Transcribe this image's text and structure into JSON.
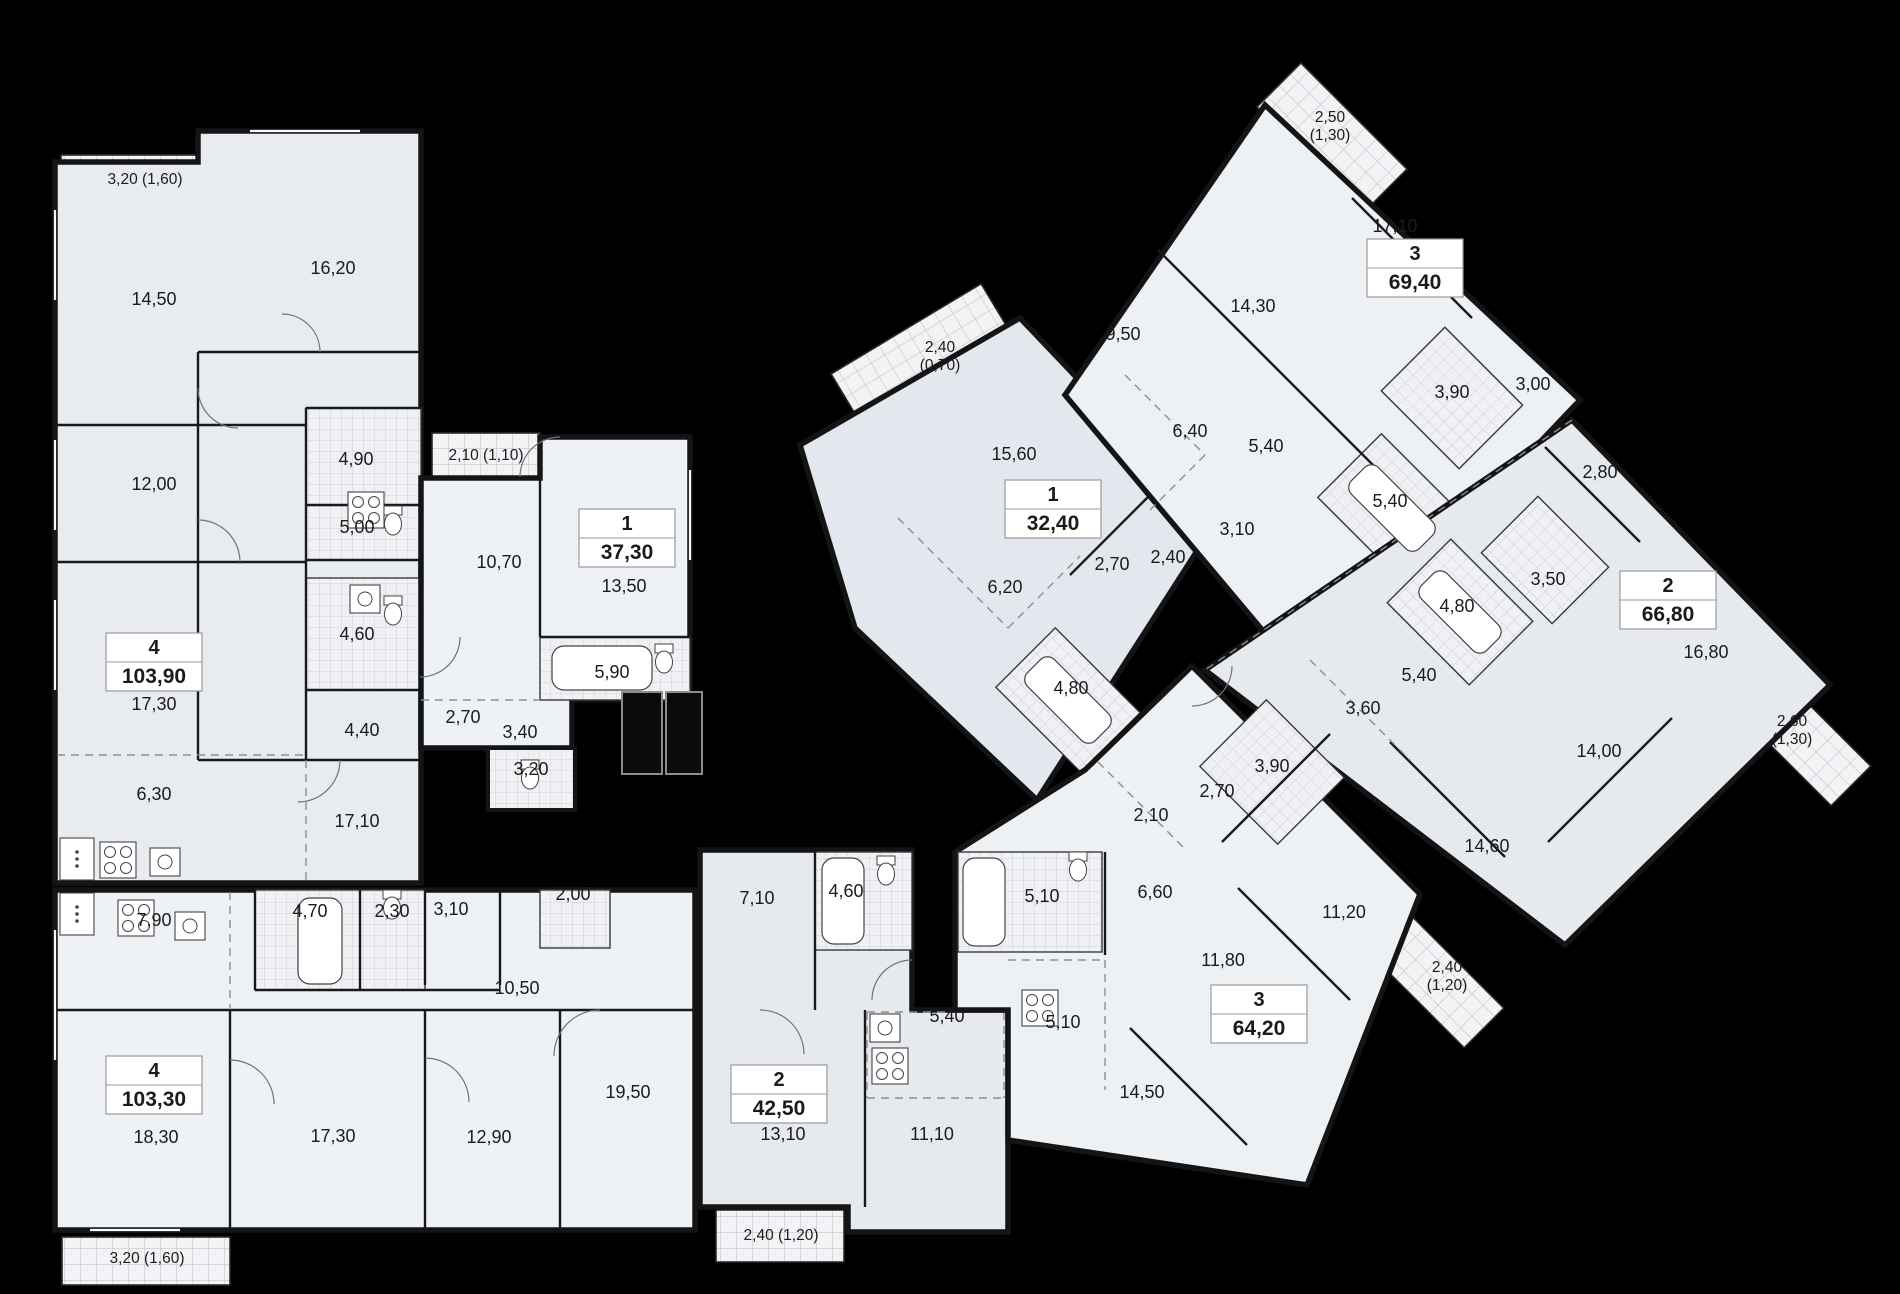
{
  "plan": {
    "background": "#000000",
    "wall_color": "#141414",
    "floor_color": "#e9edf2",
    "apartments": [
      {
        "id": "apt-4-top",
        "number": "4",
        "area": "103,90",
        "badge": {
          "x": 154,
          "y": 662
        },
        "rooms": [
          {
            "label": "14,50",
            "x": 154,
            "y": 305
          },
          {
            "label": "16,20",
            "x": 333,
            "y": 274
          },
          {
            "label": "12,00",
            "x": 154,
            "y": 490
          },
          {
            "label": "4,90",
            "x": 356,
            "y": 465
          },
          {
            "label": "5,00",
            "x": 357,
            "y": 533
          },
          {
            "label": "4,60",
            "x": 357,
            "y": 640
          },
          {
            "label": "17,30",
            "x": 154,
            "y": 710
          },
          {
            "label": "4,40",
            "x": 362,
            "y": 736
          },
          {
            "label": "6,30",
            "x": 154,
            "y": 800
          },
          {
            "label": "17,10",
            "x": 357,
            "y": 827
          }
        ],
        "balconies": [
          {
            "label": "3,20 (1,60)",
            "x": 145,
            "y": 184,
            "stacked": false
          }
        ]
      },
      {
        "id": "apt-1-37",
        "number": "1",
        "area": "37,30",
        "badge": {
          "x": 627,
          "y": 538
        },
        "rooms": [
          {
            "label": "10,70",
            "x": 499,
            "y": 568
          },
          {
            "label": "13,50",
            "x": 624,
            "y": 592
          },
          {
            "label": "5,90",
            "x": 612,
            "y": 678
          },
          {
            "label": "2,70",
            "x": 463,
            "y": 723
          },
          {
            "label": "3,40",
            "x": 520,
            "y": 738
          },
          {
            "label": "3,20",
            "x": 531,
            "y": 775
          }
        ],
        "balconies": [
          {
            "label": "2,10 (1,10)",
            "x": 486,
            "y": 460,
            "stacked": false
          }
        ]
      },
      {
        "id": "apt-4-bottom",
        "number": "4",
        "area": "103,30",
        "badge": {
          "x": 154,
          "y": 1085
        },
        "rooms": [
          {
            "label": "7,90",
            "x": 154,
            "y": 926
          },
          {
            "label": "4,70",
            "x": 310,
            "y": 917
          },
          {
            "label": "2,30",
            "x": 392,
            "y": 917
          },
          {
            "label": "3,10",
            "x": 451,
            "y": 915
          },
          {
            "label": "2,00",
            "x": 573,
            "y": 900
          },
          {
            "label": "10,50",
            "x": 517,
            "y": 994
          },
          {
            "label": "18,30",
            "x": 156,
            "y": 1143
          },
          {
            "label": "17,30",
            "x": 333,
            "y": 1142
          },
          {
            "label": "12,90",
            "x": 489,
            "y": 1143
          },
          {
            "label": "19,50",
            "x": 628,
            "y": 1098
          }
        ],
        "balconies": [
          {
            "label": "3,20 (1,60)",
            "x": 147,
            "y": 1263,
            "stacked": false
          }
        ]
      },
      {
        "id": "apt-2-42",
        "number": "2",
        "area": "42,50",
        "badge": {
          "x": 779,
          "y": 1094
        },
        "rooms": [
          {
            "label": "7,10",
            "x": 757,
            "y": 904
          },
          {
            "label": "4,60",
            "x": 846,
            "y": 897
          },
          {
            "label": "5,40",
            "x": 947,
            "y": 1022
          },
          {
            "label": "13,10",
            "x": 783,
            "y": 1140
          },
          {
            "label": "11,10",
            "x": 932,
            "y": 1140
          }
        ],
        "balconies": [
          {
            "label": "2,40 (1,20)",
            "x": 781,
            "y": 1240,
            "stacked": false
          }
        ]
      },
      {
        "id": "apt-1-32",
        "number": "1",
        "area": "32,40",
        "badge": {
          "x": 1053,
          "y": 509
        },
        "rooms": [
          {
            "label": "15,60",
            "x": 1014,
            "y": 460
          },
          {
            "label": "6,20",
            "x": 1005,
            "y": 593
          },
          {
            "label": "2,70",
            "x": 1112,
            "y": 570
          },
          {
            "label": "2,40",
            "x": 1168,
            "y": 563
          },
          {
            "label": "4,80",
            "x": 1071,
            "y": 694
          }
        ],
        "balconies": [
          {
            "label": "2,40 (0,70)",
            "x": 940,
            "y": 352,
            "stacked": true
          }
        ]
      },
      {
        "id": "apt-3-69",
        "number": "3",
        "area": "69,40",
        "badge": {
          "x": 1415,
          "y": 268
        },
        "rooms": [
          {
            "label": "17,10",
            "x": 1395,
            "y": 232
          },
          {
            "label": "14,30",
            "x": 1253,
            "y": 312
          },
          {
            "label": "9,50",
            "x": 1123,
            "y": 340
          },
          {
            "label": "6,40",
            "x": 1190,
            "y": 437
          },
          {
            "label": "5,40",
            "x": 1266,
            "y": 452
          },
          {
            "label": "3,10",
            "x": 1237,
            "y": 535
          },
          {
            "label": "3,90",
            "x": 1452,
            "y": 398
          },
          {
            "label": "5,40",
            "x": 1390,
            "y": 507
          },
          {
            "label": "3,00",
            "x": 1533,
            "y": 390
          }
        ],
        "balconies": [
          {
            "label": "2,50 (1,30)",
            "x": 1330,
            "y": 122,
            "stacked": true
          }
        ]
      },
      {
        "id": "apt-2-66",
        "number": "2",
        "area": "66,80",
        "badge": {
          "x": 1668,
          "y": 600
        },
        "rooms": [
          {
            "label": "2,80",
            "x": 1600,
            "y": 478
          },
          {
            "label": "3,50",
            "x": 1548,
            "y": 585
          },
          {
            "label": "4,80",
            "x": 1457,
            "y": 612
          },
          {
            "label": "5,40",
            "x": 1419,
            "y": 681
          },
          {
            "label": "3,60",
            "x": 1363,
            "y": 714
          },
          {
            "label": "16,80",
            "x": 1706,
            "y": 658
          },
          {
            "label": "14,00",
            "x": 1599,
            "y": 757
          },
          {
            "label": "14,60",
            "x": 1487,
            "y": 852
          }
        ],
        "balconies": [
          {
            "label": "2,60 (1,30)",
            "x": 1792,
            "y": 726,
            "stacked": true
          }
        ]
      },
      {
        "id": "apt-3-64",
        "number": "3",
        "area": "64,20",
        "badge": {
          "x": 1259,
          "y": 1014
        },
        "rooms": [
          {
            "label": "2,10",
            "x": 1151,
            "y": 821
          },
          {
            "label": "2,70",
            "x": 1217,
            "y": 797
          },
          {
            "label": "3,90",
            "x": 1272,
            "y": 772
          },
          {
            "label": "6,60",
            "x": 1155,
            "y": 898
          },
          {
            "label": "5,10",
            "x": 1042,
            "y": 902
          },
          {
            "label": "5,10",
            "x": 1063,
            "y": 1028
          },
          {
            "label": "11,80",
            "x": 1223,
            "y": 966
          },
          {
            "label": "11,20",
            "x": 1344,
            "y": 918
          },
          {
            "label": "14,50",
            "x": 1142,
            "y": 1098
          }
        ],
        "balconies": [
          {
            "label": "2,40 (1,20)",
            "x": 1447,
            "y": 972,
            "stacked": true
          }
        ]
      }
    ]
  }
}
